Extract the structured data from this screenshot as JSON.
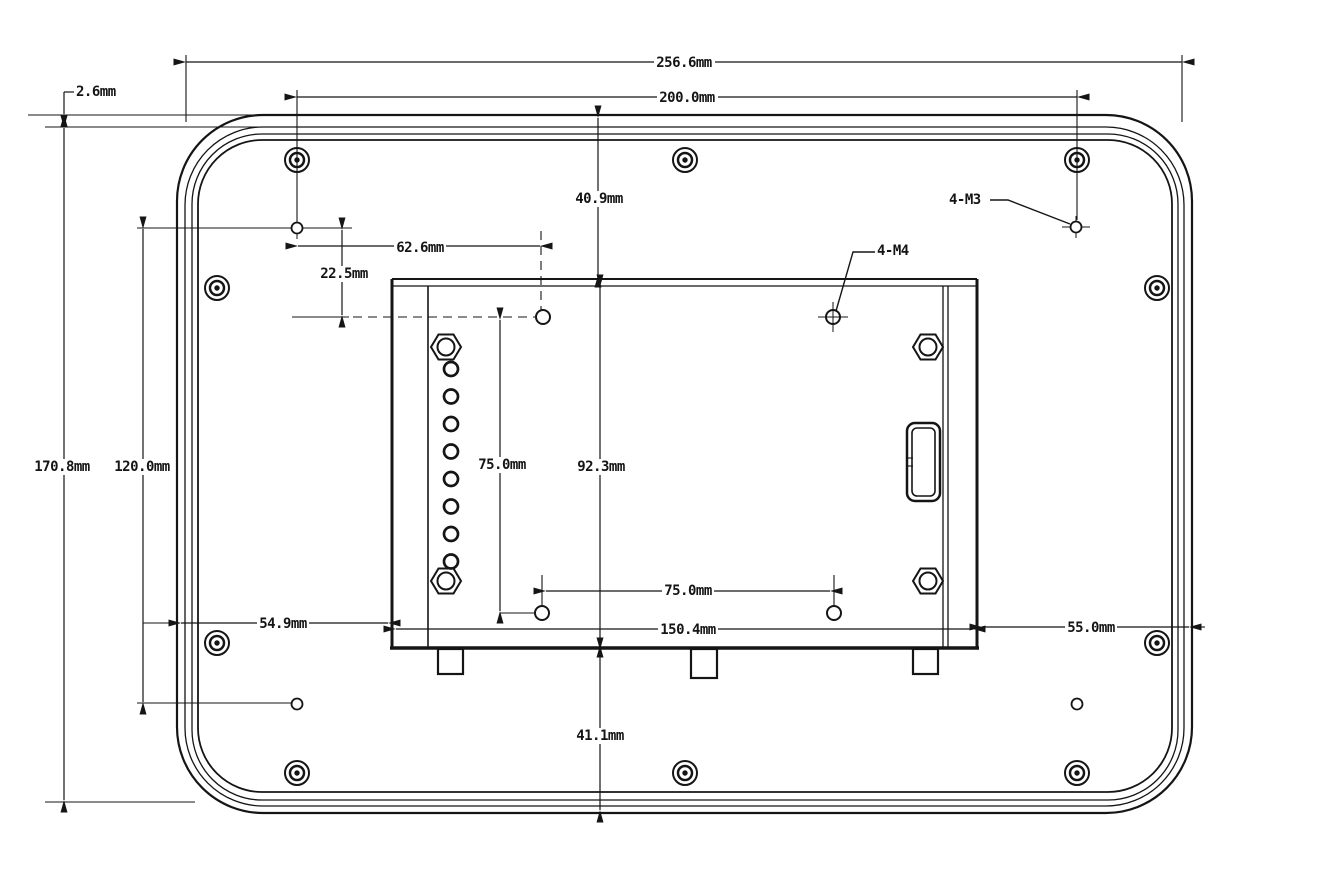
{
  "drawing": {
    "background": "#ffffff",
    "line_color": "#151515",
    "unit": "mm",
    "dims": {
      "overall_width": "256.6mm",
      "mount_width": "200.0mm",
      "front_lip": "2.6mm",
      "overall_height": "170.8mm",
      "mount_height": "120.0mm",
      "offset_x": "62.6mm",
      "offset_y": "22.5mm",
      "top_gap": "40.9mm",
      "vesa_height": "75.0mm",
      "vesa_width": "75.0mm",
      "bracket_height": "92.3mm",
      "bracket_width": "150.4mm",
      "left_gap": "54.9mm",
      "right_gap": "55.0mm",
      "bottom_gap": "41.1mm",
      "vesa_thread": "4-M4",
      "mount_thread": "4-M3"
    }
  }
}
